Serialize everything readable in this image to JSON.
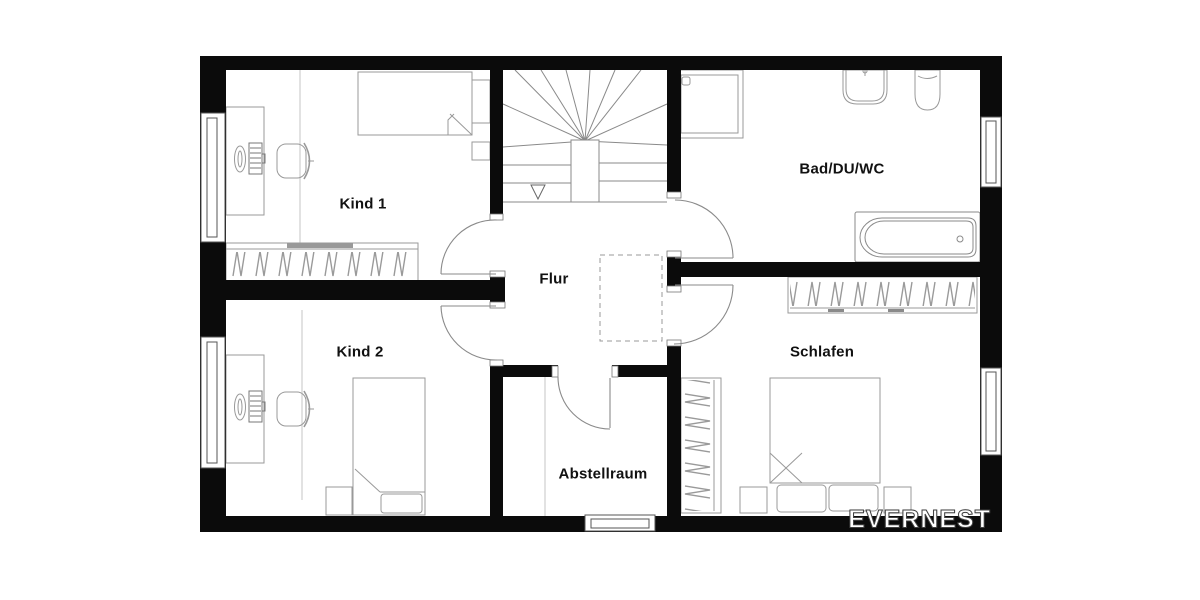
{
  "rooms": {
    "kind1": {
      "label": "Kind 1"
    },
    "kind2": {
      "label": "Kind 2"
    },
    "flur": {
      "label": "Flur"
    },
    "bad": {
      "label": "Bad/DU/WC"
    },
    "schlafen": {
      "label": "Schlafen"
    },
    "abstellraum": {
      "label": "Abstellraum"
    }
  },
  "watermark": {
    "text": "EVERNEST"
  },
  "colors": {
    "background": "#ffffff",
    "wall": "#0b0b0b",
    "drawing_line": "#8a8a8a",
    "furniture_line": "#999999",
    "faint_line": "#c6c6c6",
    "label_text": "#111111",
    "watermark_fill": "#ffffff",
    "watermark_outline": "#3f3f3f"
  }
}
